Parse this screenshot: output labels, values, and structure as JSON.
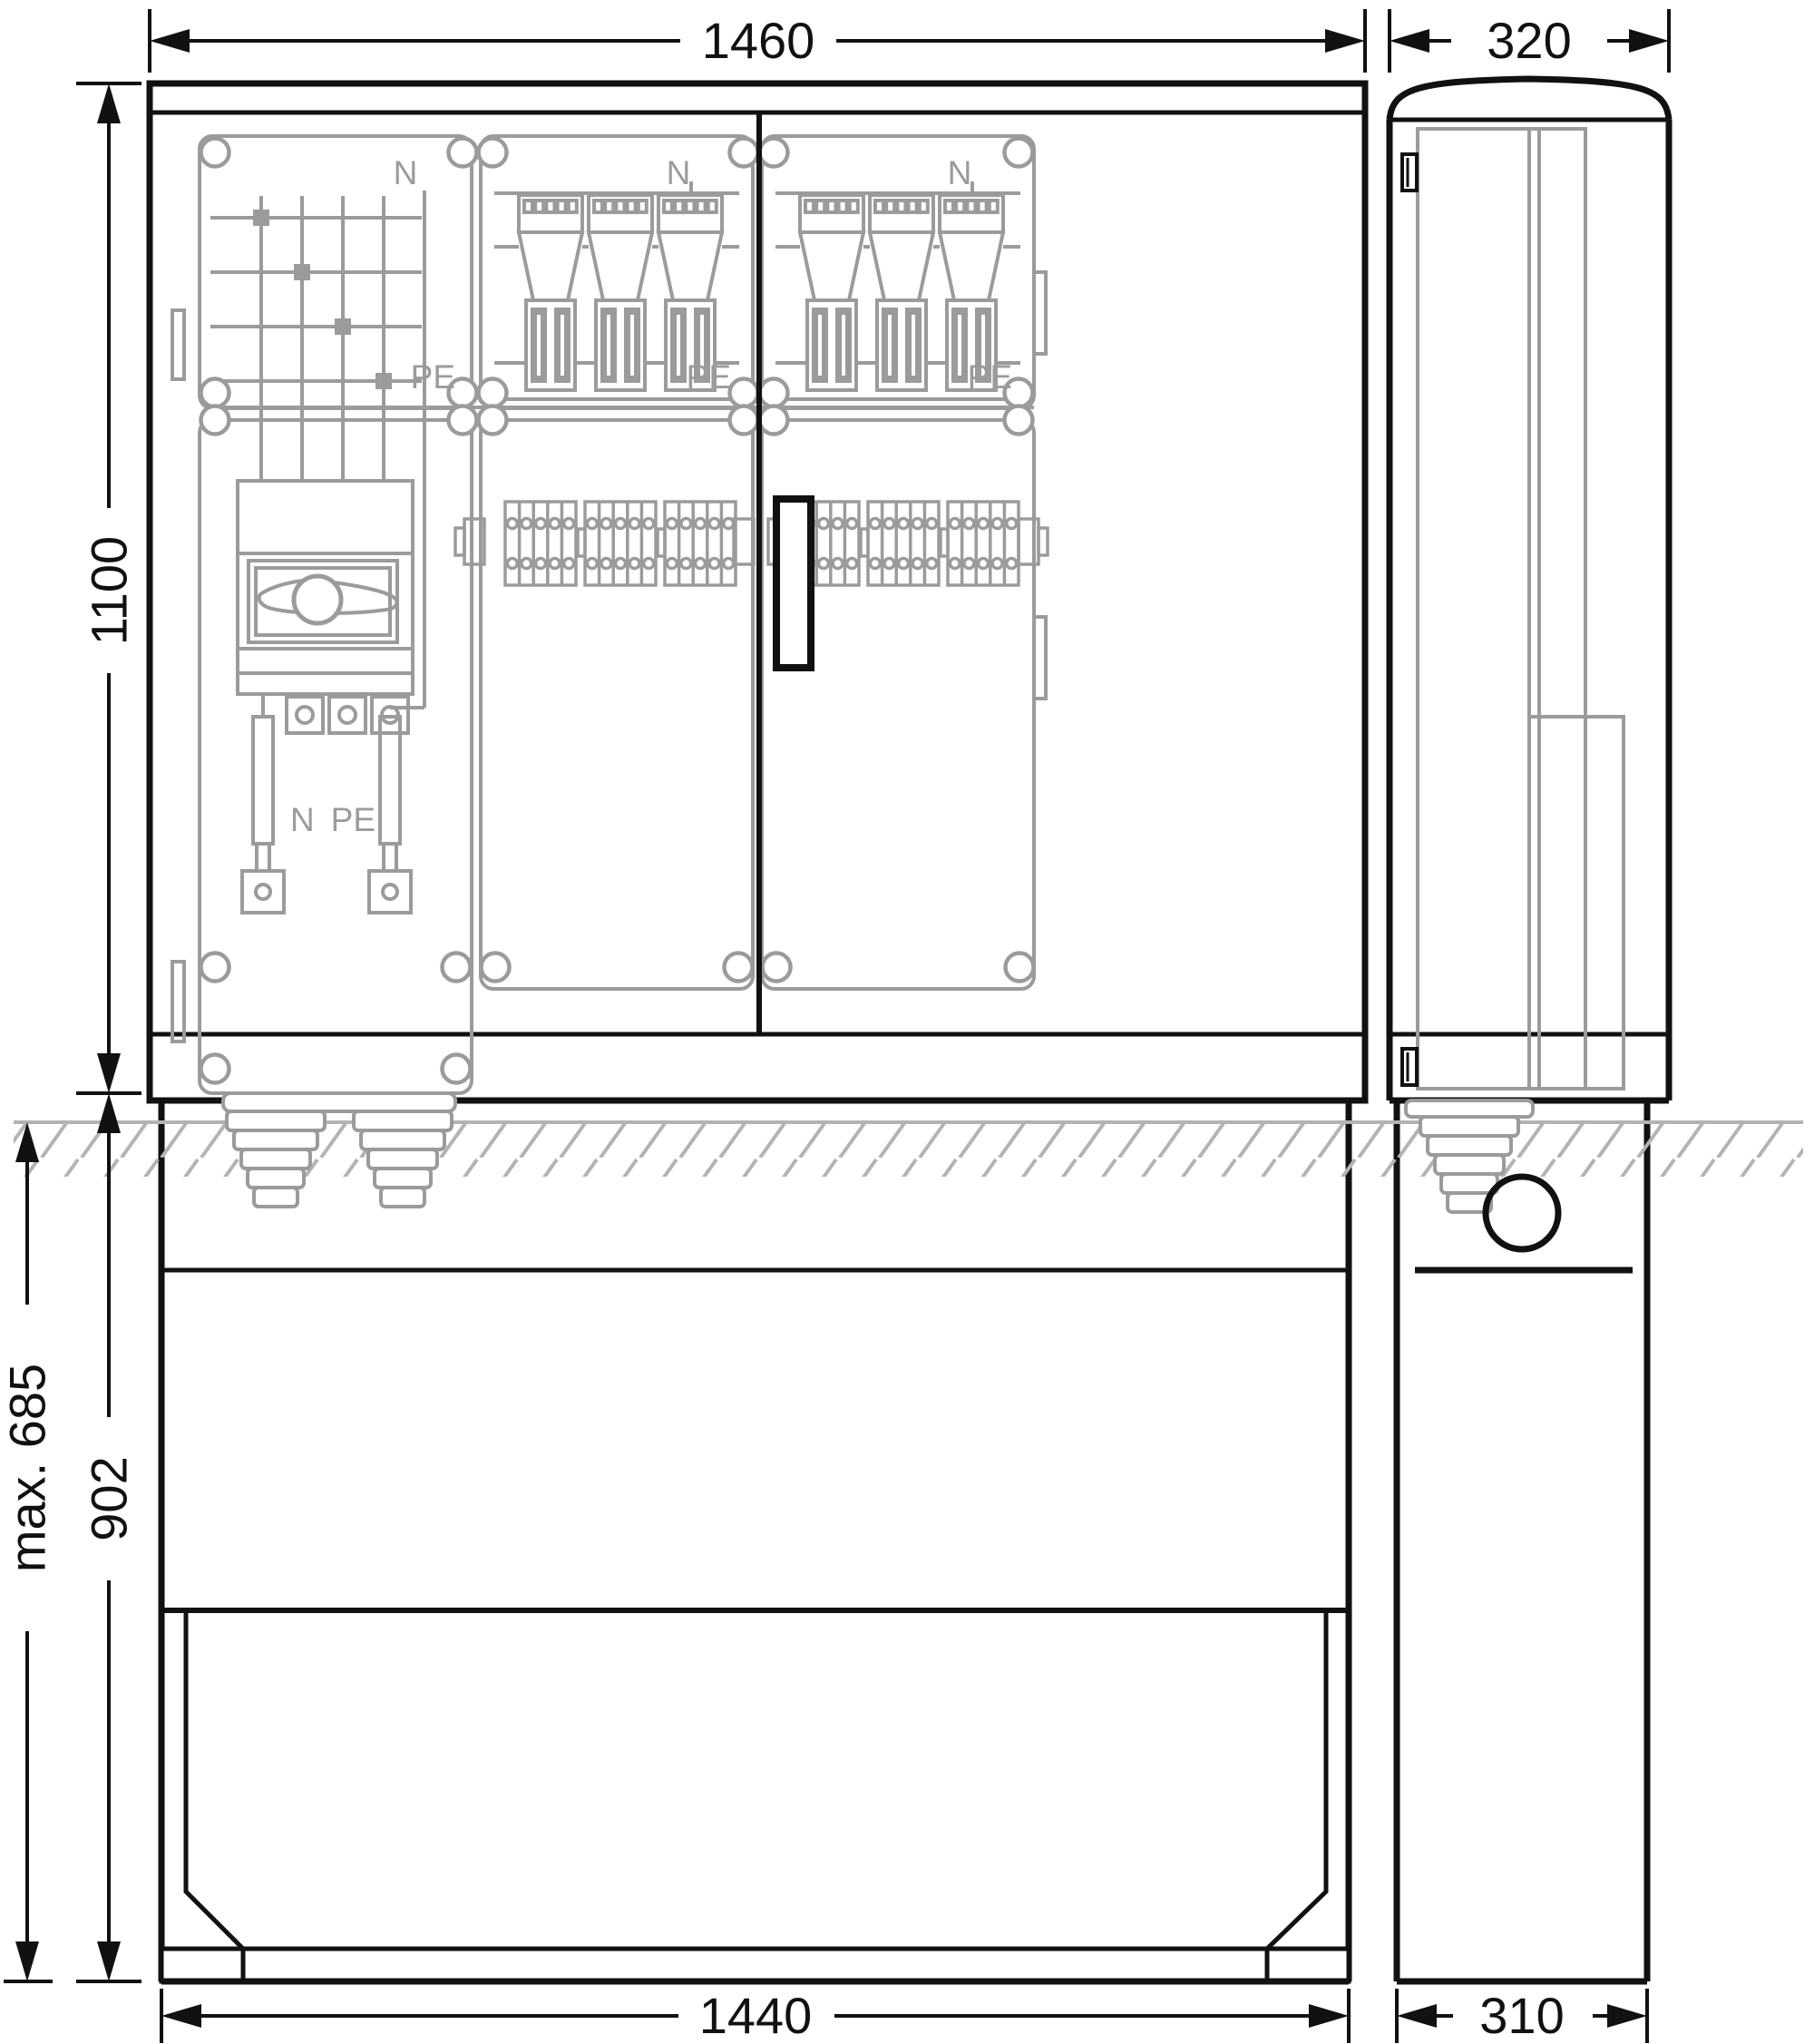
{
  "drawing": {
    "kind": "technical dimension drawing",
    "views": {
      "front": "front view",
      "side": "side view"
    }
  },
  "dims": {
    "front_width": "1460",
    "side_width": "320",
    "front_height": "1100",
    "base_height": "902",
    "max_burial": "max. 685",
    "base_width": "1440",
    "base_depth": "310"
  },
  "ghost_labels": {
    "n1": "N",
    "n2": "N",
    "n3": "N",
    "pe1": "PE",
    "pe2": "PE",
    "pe3": "PE",
    "n_bar": "N",
    "pe_bar": "PE"
  },
  "colors": {
    "line": "#111111",
    "ghost": "#9b9b9b",
    "hatch": "#b3b3b3",
    "background": "#ffffff"
  }
}
